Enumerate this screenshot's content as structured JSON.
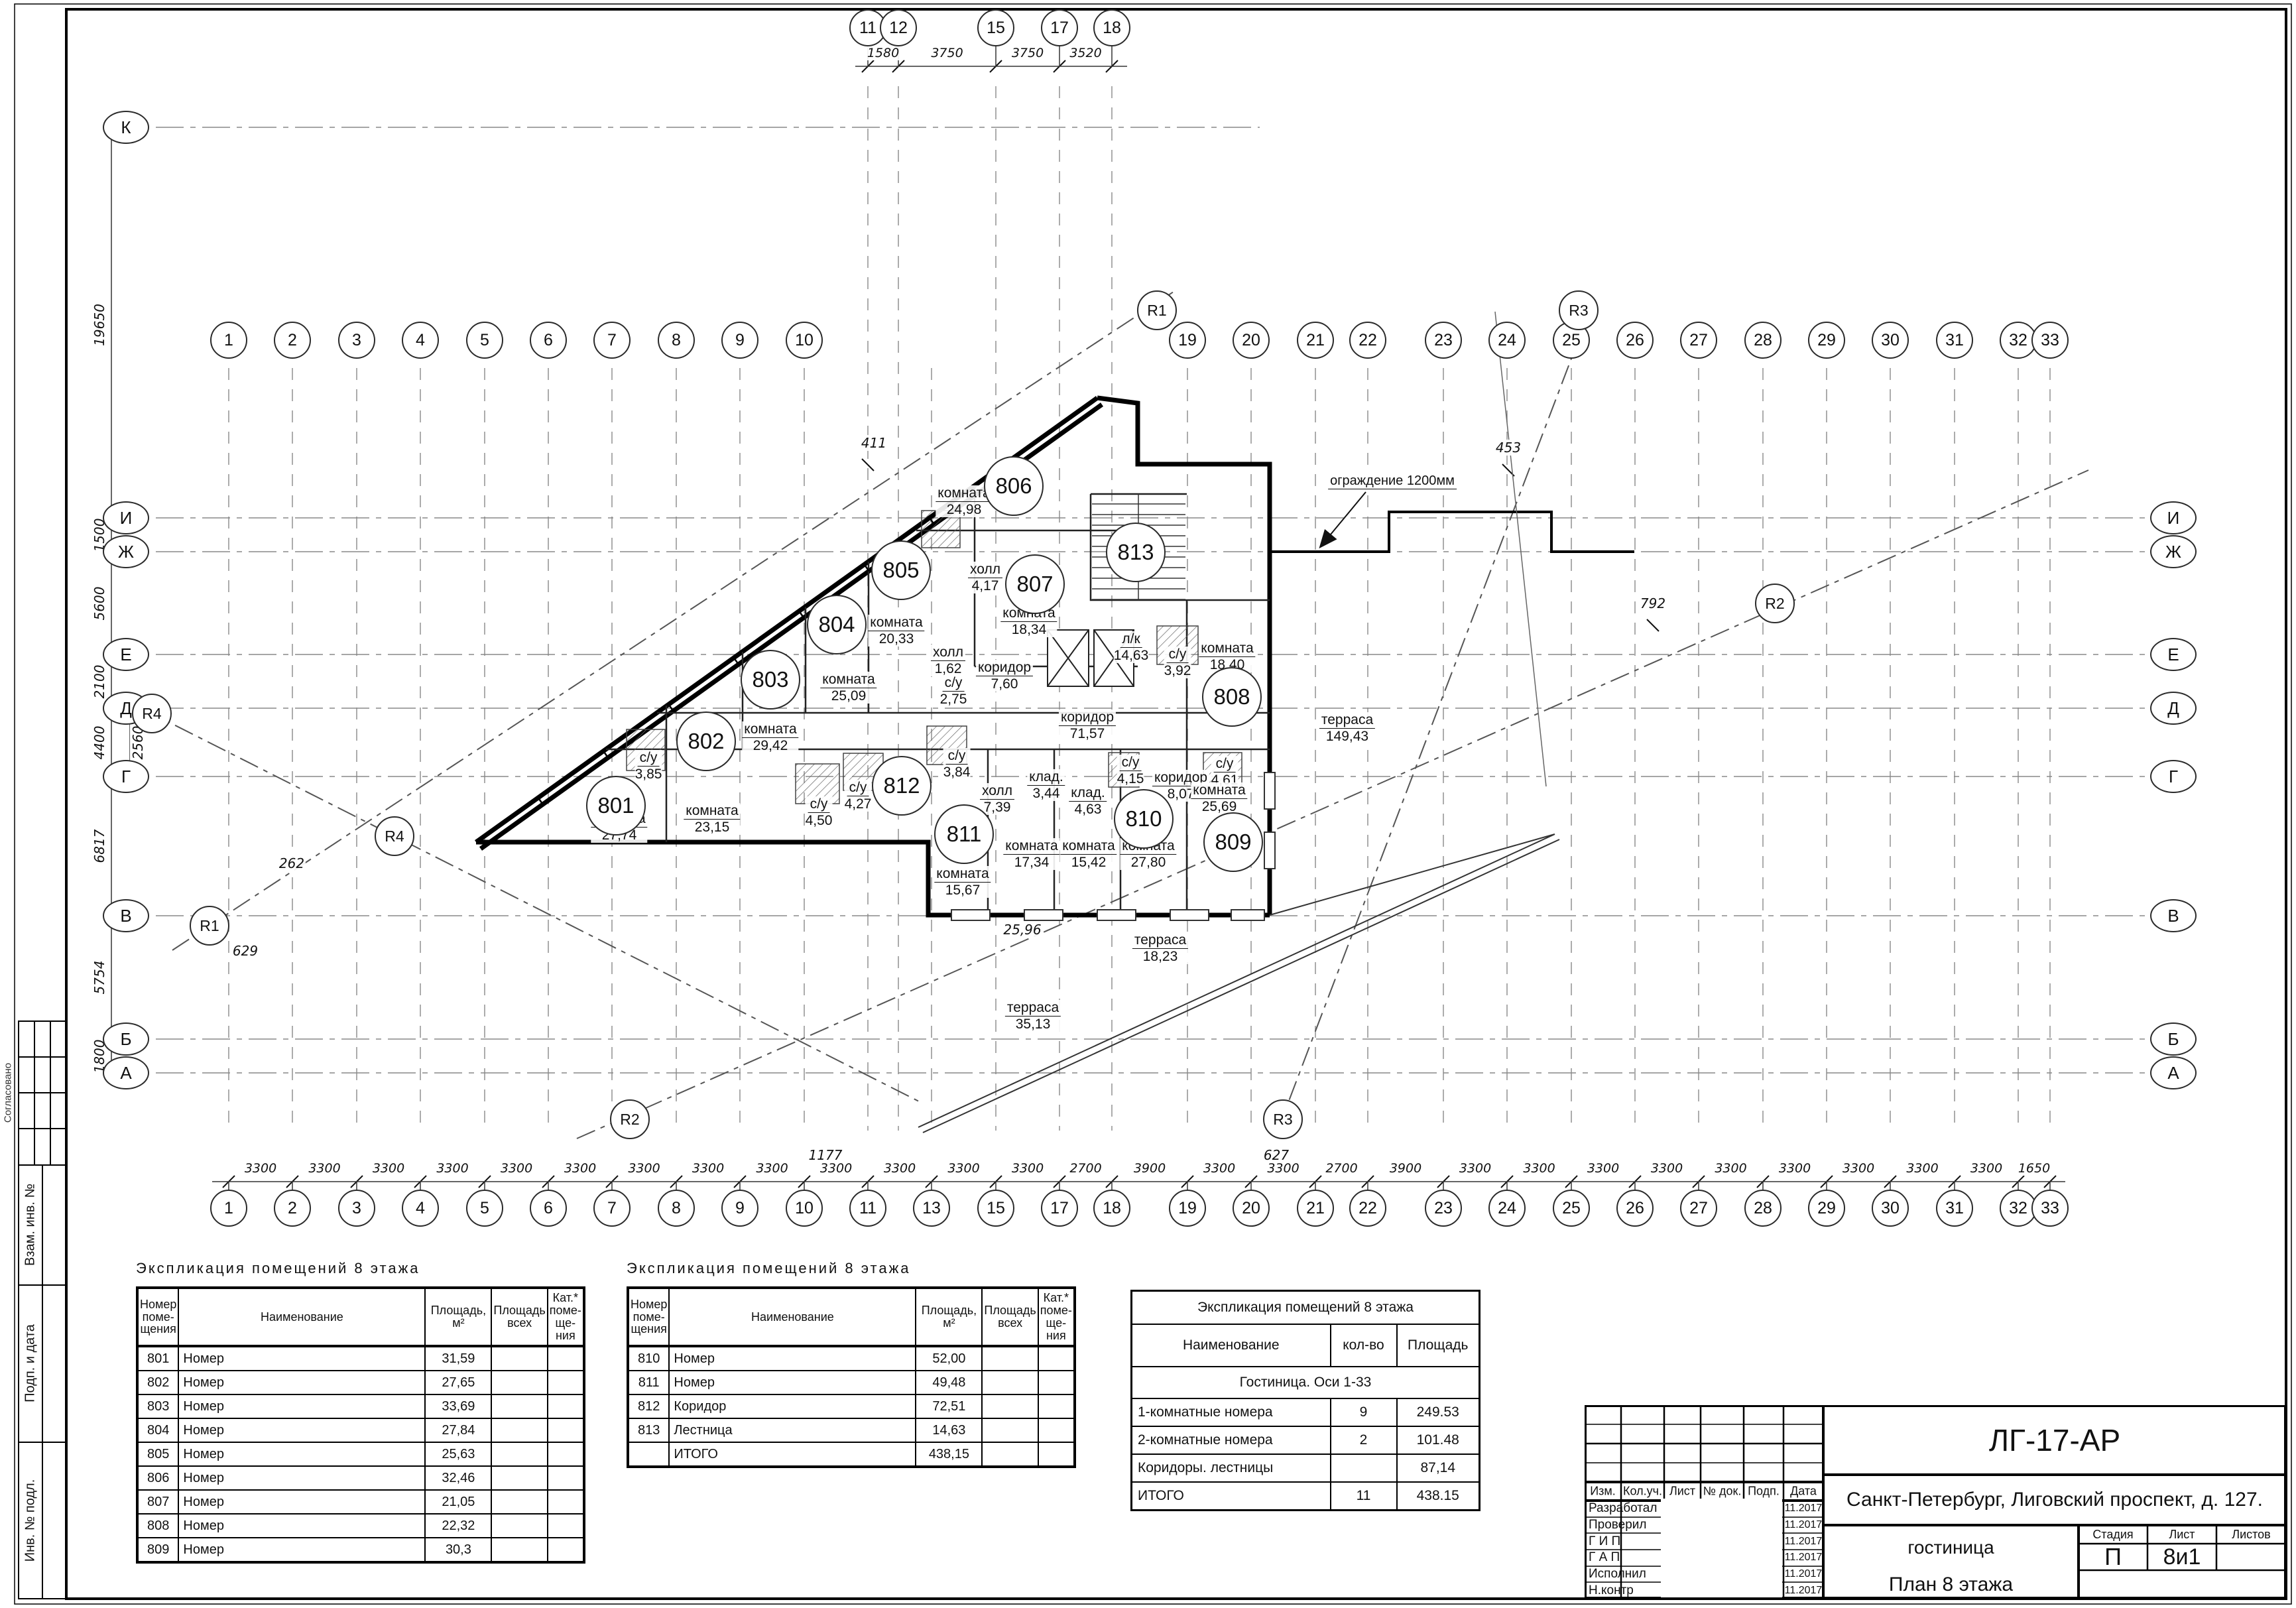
{
  "axes": {
    "top": {
      "labels": [
        "11",
        "12",
        "15",
        "17",
        "18"
      ],
      "dims": [
        "1580",
        "3750",
        "3750",
        "3520"
      ]
    },
    "bottom": {
      "labels": [
        "1",
        "2",
        "3",
        "4",
        "5",
        "6",
        "7",
        "8",
        "9",
        "10",
        "11",
        "13",
        "15",
        "17",
        "18",
        "19",
        "20",
        "21",
        "22",
        "23",
        "24",
        "25",
        "26",
        "27",
        "28",
        "29",
        "30",
        "31",
        "32",
        "33"
      ],
      "dims": [
        "3300",
        "3300",
        "3300",
        "3300",
        "3300",
        "3300",
        "3300",
        "3300",
        "3300",
        "3300",
        "3300",
        "3300",
        "3300",
        "2700",
        "3900",
        "3300",
        "3300",
        "2700",
        "3900",
        "3300",
        "3300",
        "3300",
        "3300",
        "3300",
        "3300",
        "3300",
        "3300",
        "3300",
        "1650"
      ]
    },
    "mid_left": [
      "1",
      "2",
      "3",
      "4",
      "5",
      "6",
      "7",
      "8",
      "9",
      "10"
    ],
    "mid_right": [
      "19",
      "20",
      "21",
      "22",
      "23",
      "24",
      "25",
      "26",
      "27",
      "28",
      "29",
      "30",
      "31",
      "32",
      "33"
    ],
    "left_letters": [
      "К",
      "И",
      "Ж",
      "Е",
      "Д",
      "Г",
      "В",
      "Б",
      "А"
    ],
    "right_letters": [
      "И",
      "Ж",
      "Е",
      "Д",
      "Г",
      "В",
      "Б",
      "А"
    ],
    "left_dims": [
      "19650",
      "1500",
      "5600",
      "2100",
      "4400",
      "2560",
      "6817",
      "5754",
      "1800"
    ],
    "radius_labels": {
      "r1": "R1",
      "r2": "R2",
      "r3": "R3",
      "r4": "R4"
    }
  },
  "plan": {
    "rooms": [
      {
        "number": "801"
      },
      {
        "number": "802"
      },
      {
        "number": "803"
      },
      {
        "number": "804"
      },
      {
        "number": "805"
      },
      {
        "number": "806"
      },
      {
        "number": "807"
      },
      {
        "number": "808"
      },
      {
        "number": "809"
      },
      {
        "number": "810"
      },
      {
        "number": "811"
      },
      {
        "number": "812"
      },
      {
        "number": "813"
      }
    ],
    "labels": [
      {
        "name": "комната",
        "area": "27,74"
      },
      {
        "name": "комната",
        "area": "23,15"
      },
      {
        "name": "с/у",
        "area": "3,85"
      },
      {
        "name": "комната",
        "area": "29,42"
      },
      {
        "name": "комната",
        "area": "25,09"
      },
      {
        "name": "комната",
        "area": "20,33"
      },
      {
        "name": "комната",
        "area": "24,98"
      },
      {
        "name": "комната",
        "area": "18,34"
      },
      {
        "name": "холл",
        "area": "4,17"
      },
      {
        "name": "холл",
        "area": "1,62"
      },
      {
        "name": "с/у",
        "area": "2,75"
      },
      {
        "name": "коридор",
        "area": "7,60"
      },
      {
        "name": "л/к",
        "area": "14,63"
      },
      {
        "name": "с/у",
        "area": "3,92"
      },
      {
        "name": "комната",
        "area": "18,40"
      },
      {
        "name": "коридор",
        "area": "71,57"
      },
      {
        "name": "терраса",
        "area": "149,43"
      },
      {
        "name": "с/у",
        "area": "3,84"
      },
      {
        "name": "с/у",
        "area": "4,50"
      },
      {
        "name": "с/у",
        "area": "4,27"
      },
      {
        "name": "холл",
        "area": "7,39"
      },
      {
        "name": "клад.",
        "area": "3,44"
      },
      {
        "name": "клад.",
        "area": "4,63"
      },
      {
        "name": "с/у",
        "area": "4,15"
      },
      {
        "name": "коридор",
        "area": "8,07"
      },
      {
        "name": "с/у",
        "area": "4,61"
      },
      {
        "name": "комната",
        "area": "15,67"
      },
      {
        "name": "комната",
        "area": "17,34"
      },
      {
        "name": "комната",
        "area": "15,42"
      },
      {
        "name": "комната",
        "area": "27,80"
      },
      {
        "name": "комната",
        "area": "25,69"
      },
      {
        "name": "терраса",
        "area": "18,23"
      },
      {
        "name": "терраса",
        "area": "35,13"
      }
    ],
    "annotations": {
      "fence": "ограждение 1200мм",
      "dim411": "411",
      "dim453": "453",
      "dim792": "792",
      "dim262": "262",
      "dim629": "629",
      "dim1177": "1177",
      "dim627": "627",
      "dim2596": "25,96"
    }
  },
  "tables": {
    "expl1": {
      "title": "Экспликация помещений 8 этажа",
      "headers": [
        "Номер\nпоме-\nщения",
        "Наименование",
        "Площадь,\nм²",
        "Площадь\nвсех",
        "Кат.*\nпоме-\nще-\nния"
      ],
      "rows": [
        [
          "801",
          "Номер",
          "31,59"
        ],
        [
          "802",
          "Номер",
          "27,65"
        ],
        [
          "803",
          "Номер",
          "33,69"
        ],
        [
          "804",
          "Номер",
          "27,84"
        ],
        [
          "805",
          "Номер",
          "25,63"
        ],
        [
          "806",
          "Номер",
          "32,46"
        ],
        [
          "807",
          "Номер",
          "21,05"
        ],
        [
          "808",
          "Номер",
          "22,32"
        ],
        [
          "809",
          "Номер",
          "30,3"
        ]
      ]
    },
    "expl2": {
      "title": "Экспликация помещений 8 этажа",
      "headers": [
        "Номер\nпоме-\nщения",
        "Наименование",
        "Площадь,\nм²",
        "Площадь\nвсех",
        "Кат.*\nпоме-\nще-\nния"
      ],
      "rows": [
        [
          "810",
          "Номер",
          "52,00"
        ],
        [
          "811",
          "Номер",
          "49,48"
        ],
        [
          "812",
          "Коридор",
          "72,51"
        ],
        [
          "813",
          "Лестница",
          "14,63"
        ],
        [
          "",
          "ИТОГО",
          "438,15"
        ]
      ]
    },
    "summary": {
      "title": "Экспликация помещений 8 этажа",
      "headers": [
        "Наименование",
        "кол-во",
        "Площадь"
      ],
      "group": "Гостиница. Оси 1-33",
      "rows": [
        [
          "1-комнатные номера",
          "9",
          "249.53"
        ],
        [
          "2-комнатные номера",
          "2",
          "101.48"
        ],
        [
          "Коридоры. лестницы",
          "",
          "87,14"
        ],
        [
          "ИТОГО",
          "11",
          "438.15"
        ]
      ]
    }
  },
  "titleblock": {
    "code": "ЛГ-17-АР",
    "address": "Санкт-Петербург, Лиговский проспект, д. 127.",
    "cols": [
      "Изм.",
      "Кол.уч.",
      "Лист",
      "№ док.",
      "Подп.",
      "Дата"
    ],
    "roles": [
      "Разработал",
      "Проверил",
      "Г И П",
      "Г А П",
      "Исполнил",
      "Н.контр"
    ],
    "date": "11.2017",
    "object": "гостиница",
    "sheet_title": "План 8 этажа",
    "stage_label": "Стадия",
    "sheet_label": "Лист",
    "sheets_label": "Листов",
    "stage": "П",
    "sheet": "8и1"
  },
  "sidebar": {
    "agreed": "Согласовано",
    "labels": [
      "Взам. инв. №",
      "Подп. и дата",
      "Инв. № подл."
    ]
  }
}
